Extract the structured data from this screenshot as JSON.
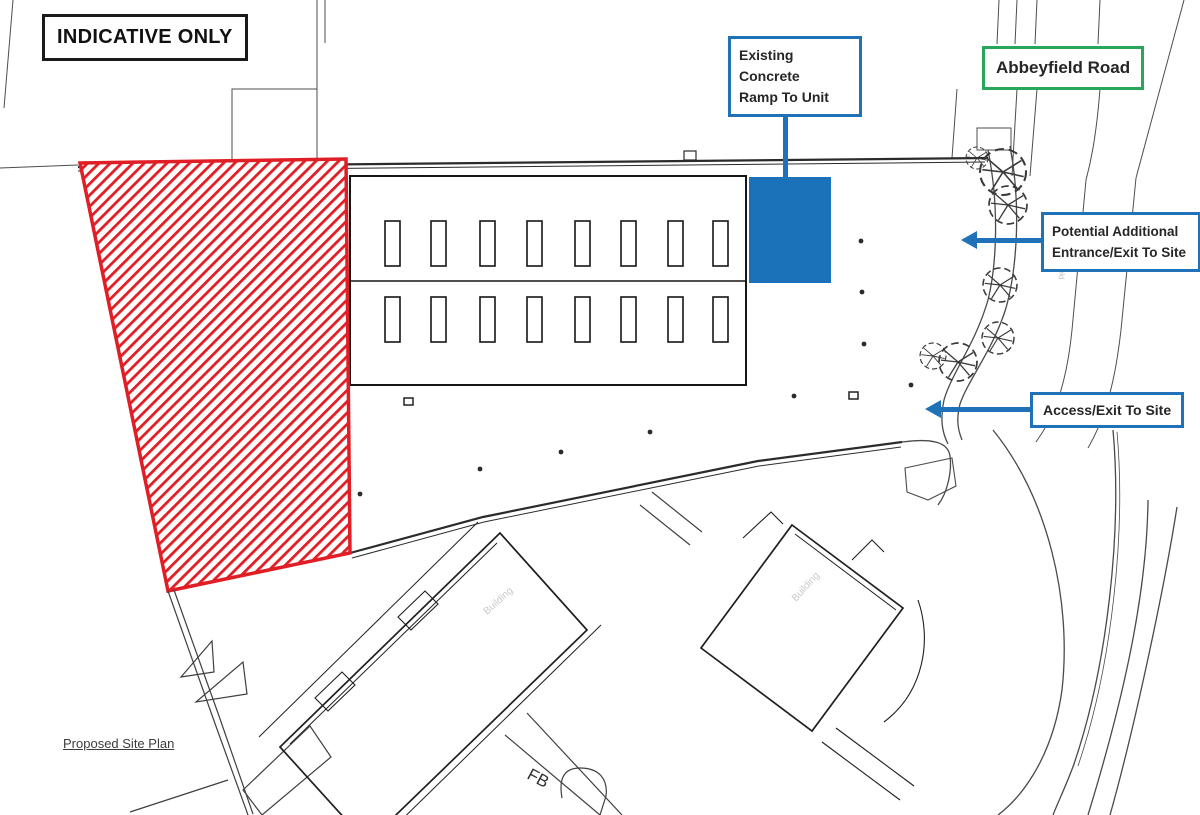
{
  "title_box": {
    "label": "INDICATIVE ONLY"
  },
  "annotations": {
    "ramp": {
      "line1": "Existing Concrete",
      "line2": "Ramp To Unit"
    },
    "road": {
      "label": "Abbeyfield Road"
    },
    "potential": {
      "line1": "Potential Additional",
      "line2": "Entrance/Exit To Site"
    },
    "access": {
      "label": "Access/Exit To Site"
    }
  },
  "map_texts": {
    "plan_title": "Proposed Site Plan",
    "footbridge": "FB",
    "building_faint": "Building",
    "road_faint_vertical": "Abbeyfield"
  },
  "colors": {
    "annotation_blue": "#1F72B8",
    "ramp_fill_blue": "#1B72B8",
    "road_green": "#27A65C",
    "hatch_red": "#E01E25",
    "ink": "#1A1A1A"
  }
}
